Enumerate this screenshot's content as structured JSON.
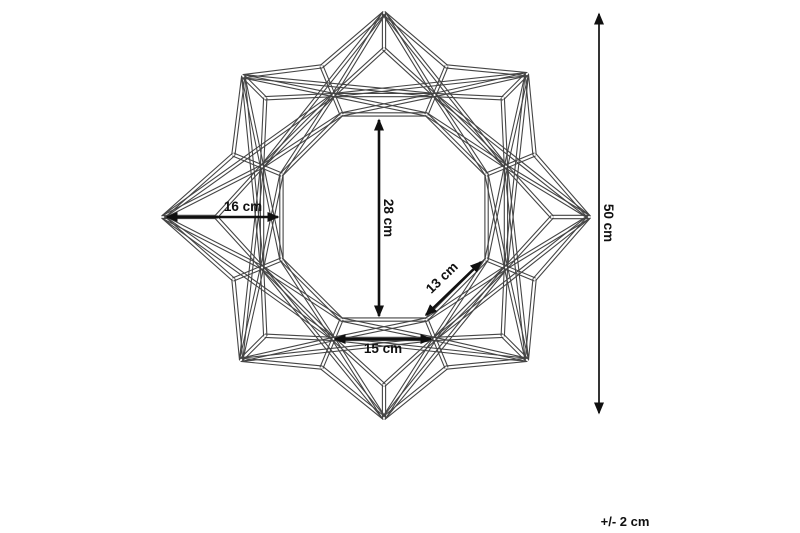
{
  "diagram": {
    "kind": "product-dimension-diagram",
    "subject": "geometric-star-wall-mirror-wireframe",
    "labels": {
      "point_to_frame": "16 cm",
      "opening_height": "28 cm",
      "facet_edge": "13 cm",
      "bottom_edge": "15 cm",
      "overall_height": "50 cm",
      "tolerance": "+/- 2 cm"
    },
    "colors": {
      "background": "#ffffff",
      "wire": "#454545",
      "dimension": "#101010"
    }
  }
}
